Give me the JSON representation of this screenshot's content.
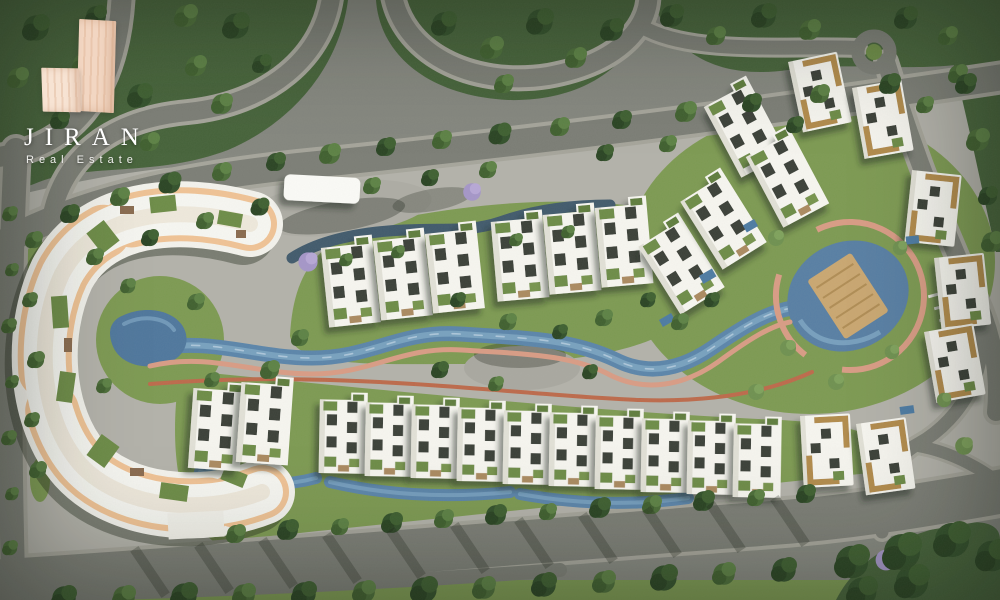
{
  "brand": {
    "name": "JIRAN",
    "tagline": "Real Estate",
    "mark_icon": "two-tower-building-mark",
    "colors": {
      "mark_light": "#f7e3d3",
      "mark_dark": "#f2d6c2",
      "text": "#ffffff"
    }
  },
  "scene": {
    "description": "Aerial master-plan render of a residential compound",
    "palette": {
      "asphalt": "#7c7e76",
      "sidewalk": "#a6a59b",
      "paving": "#b3b2aa",
      "forest_green": "#46633a",
      "lawn_green": "#7d9a52",
      "building_white": "#f7f6f0",
      "terracotta_band": "#f0c395",
      "running_track_pink": "#d99c85",
      "running_track_red": "#bd6a4b",
      "pool_water": "#5b85aa",
      "window_dark": "#3b3f37",
      "gold_trim": "#b28b4b",
      "deck_wood": "#caa771"
    },
    "features": [
      "crescent-apartment-building",
      "townhouse-clusters",
      "gold-trim-villas",
      "lazy-river",
      "amenity-pool-with-deck-island",
      "running-track",
      "tree-lined-avenue",
      "perimeter-roads"
    ]
  }
}
